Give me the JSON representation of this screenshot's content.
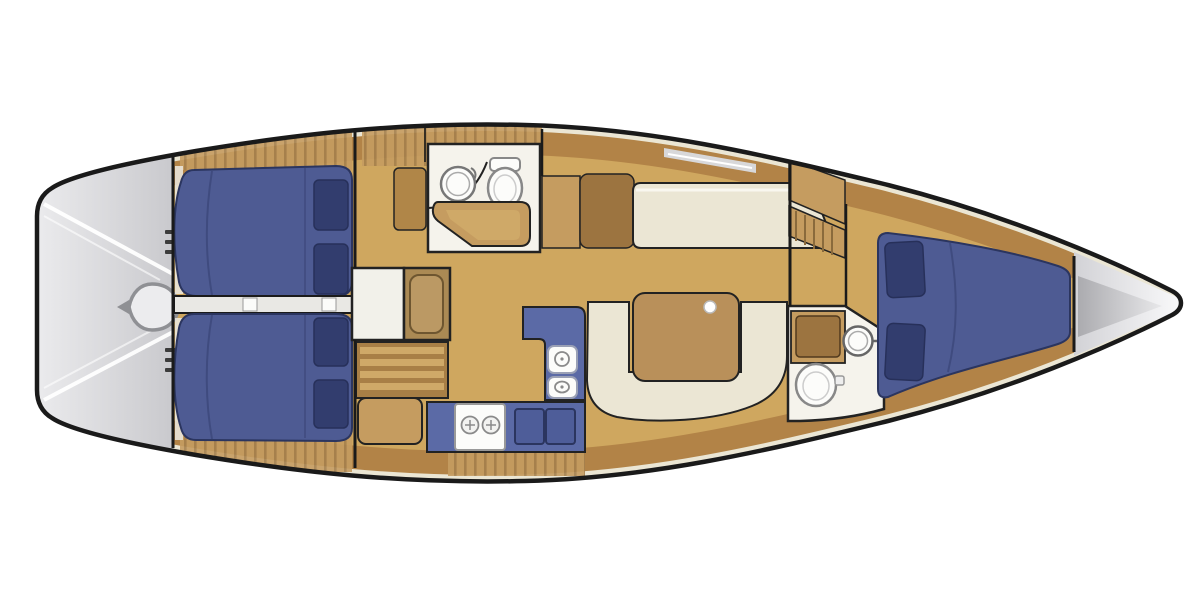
{
  "meta": {
    "type": "sailboat-interior-floor-plan",
    "view": "top-down",
    "orientation": "bow-right"
  },
  "areas": {
    "transom": "swim-platform-and-helm",
    "aft_cabin_port": "aft-double-berth-port",
    "aft_cabin_starboard": "aft-double-berth-starboard",
    "companionway": "companionway-steps-and-landing",
    "aft_head": "aft-head-sink-toilet",
    "port_settee": "salon-settee-port",
    "dinette": "salon-dinette-table-starboard",
    "galley": "l-shaped-galley-stove-sinks",
    "forward_head": "forward-head-vanity-sink-toilet",
    "forward_cabin": "forward-v-berth-cabin",
    "hanging_locker": "hanging-locker",
    "anchor_locker": "bow-anchor-locker"
  },
  "fixtures": [
    "helm-wheel-icon",
    "round-sink-icon",
    "toilet-icon",
    "two-burner-stove-icon",
    "double-sink-icon",
    "salon-table",
    "mast-post",
    "berth-pillows",
    "ladder-steps"
  ],
  "colors": {
    "hull_outline": "#1a1a1a",
    "hull_fill": "#ffffff",
    "floor_tan": "#cfa75f",
    "wood_band": "#b28347",
    "cabinet_tan": "#c59c60",
    "wood_dark": "#9c7440",
    "cream": "#ebe6d4",
    "white_floor": "#f5f3ec",
    "berth_blue": "#4e5b93",
    "berth_edge": "#2b355f",
    "pillow_navy": "#323d6e",
    "counter_blue": "#5b6aa6",
    "counter_inner": "#4e5d99",
    "fixture_white": "#fcfcfa",
    "fixture_stroke": "#8a8a8a",
    "table_wood": "#b9905a",
    "deck_gray_light": "#ededef",
    "deck_gray": "#c9c9cd",
    "anchor_wedge": "#ababaf",
    "stripe_white": "#ffffff",
    "wall": "#222222",
    "wood_seam": "#8a6a3c"
  }
}
